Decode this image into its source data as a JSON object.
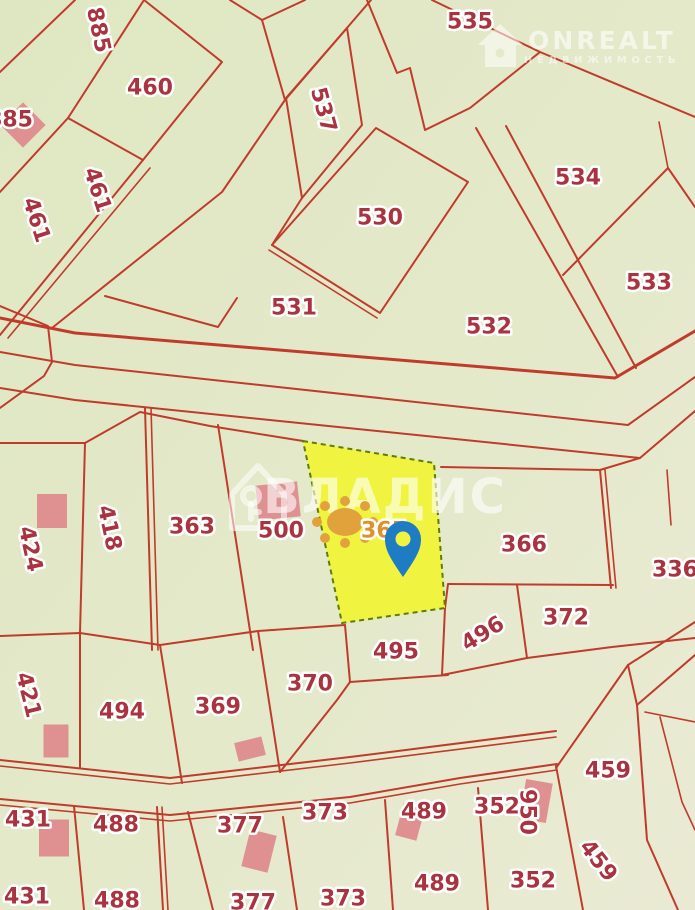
{
  "watermarks": {
    "top_right": {
      "brand": "ONREALT",
      "tagline": "НЕДВИЖИМОСТЬ"
    },
    "center": {
      "brand": "ВЛАДИС"
    }
  },
  "map": {
    "colors": {
      "background_top": "#dfe7c2",
      "background_bottom": "#eaead4",
      "boundary_line": "#c03b2c",
      "parcel_label": "#aa3340",
      "building_fill": "#df9191",
      "highlight_fill": "#f0f441",
      "highlight_border": "#5f7c05",
      "pin_color": "#1d7cc3",
      "accent_label": "#df9027"
    },
    "selected_parcel": {
      "number": "365",
      "label_x": 384,
      "label_y": 531,
      "pin": {
        "x": 403,
        "y": 577
      },
      "site_icon": {
        "cx": 345,
        "cy": 522,
        "color": "#e2a23b"
      }
    },
    "parcel_labels": [
      {
        "text": "885",
        "x": 98,
        "y": 30,
        "rot": 78
      },
      {
        "text": "460",
        "x": 150,
        "y": 88,
        "rot": 0
      },
      {
        "text": "885",
        "x": 10,
        "y": 120,
        "rot": 0
      },
      {
        "text": "461",
        "x": 97,
        "y": 190,
        "rot": 72
      },
      {
        "text": "461",
        "x": 36,
        "y": 220,
        "rot": 72
      },
      {
        "text": "535",
        "x": 470,
        "y": 22,
        "rot": 0
      },
      {
        "text": "537",
        "x": 323,
        "y": 110,
        "rot": 75
      },
      {
        "text": "530",
        "x": 380,
        "y": 218,
        "rot": 0
      },
      {
        "text": "534",
        "x": 578,
        "y": 178,
        "rot": 0
      },
      {
        "text": "531",
        "x": 294,
        "y": 308,
        "rot": 0
      },
      {
        "text": "532",
        "x": 489,
        "y": 327,
        "rot": 0
      },
      {
        "text": "533",
        "x": 649,
        "y": 283,
        "rot": 0
      },
      {
        "text": "424",
        "x": 30,
        "y": 549,
        "rot": 78
      },
      {
        "text": "418",
        "x": 109,
        "y": 528,
        "rot": 78
      },
      {
        "text": "363",
        "x": 192,
        "y": 527,
        "rot": 0
      },
      {
        "text": "500",
        "x": 281,
        "y": 531,
        "rot": 0
      },
      {
        "text": "366",
        "x": 524,
        "y": 545,
        "rot": 0
      },
      {
        "text": "336",
        "x": 675,
        "y": 570,
        "rot": 0
      },
      {
        "text": "372",
        "x": 566,
        "y": 618,
        "rot": 0
      },
      {
        "text": "496",
        "x": 483,
        "y": 634,
        "rot": -32
      },
      {
        "text": "495",
        "x": 396,
        "y": 652,
        "rot": 0
      },
      {
        "text": "370",
        "x": 310,
        "y": 684,
        "rot": 0
      },
      {
        "text": "421",
        "x": 28,
        "y": 695,
        "rot": 76
      },
      {
        "text": "494",
        "x": 122,
        "y": 712,
        "rot": 0
      },
      {
        "text": "369",
        "x": 218,
        "y": 707,
        "rot": 0
      },
      {
        "text": "431",
        "x": 28,
        "y": 820,
        "rot": 0
      },
      {
        "text": "488",
        "x": 116,
        "y": 825,
        "rot": 0
      },
      {
        "text": "377",
        "x": 240,
        "y": 826,
        "rot": 0
      },
      {
        "text": "373",
        "x": 325,
        "y": 813,
        "rot": 0
      },
      {
        "text": "489",
        "x": 424,
        "y": 812,
        "rot": 0
      },
      {
        "text": "352",
        "x": 497,
        "y": 807,
        "rot": 0
      },
      {
        "text": "950",
        "x": 527,
        "y": 812,
        "rot": 90
      },
      {
        "text": "459",
        "x": 608,
        "y": 771,
        "rot": 0
      },
      {
        "text": "459",
        "x": 598,
        "y": 861,
        "rot": 52
      },
      {
        "text": "431",
        "x": 27,
        "y": 897,
        "rot": 0
      },
      {
        "text": "488",
        "x": 117,
        "y": 901,
        "rot": 0
      },
      {
        "text": "377",
        "x": 253,
        "y": 903,
        "rot": 0
      },
      {
        "text": "373",
        "x": 343,
        "y": 899,
        "rot": 0
      },
      {
        "text": "489",
        "x": 437,
        "y": 884,
        "rot": 0
      },
      {
        "text": "352",
        "x": 533,
        "y": 881,
        "rot": 0
      }
    ],
    "buildings": [
      {
        "cx": 23,
        "cy": 125,
        "w": 32,
        "h": 32,
        "rot": 45
      },
      {
        "cx": 52,
        "cy": 511,
        "w": 30,
        "h": 34,
        "rot": 0
      },
      {
        "cx": 278,
        "cy": 501,
        "w": 42,
        "h": 35,
        "rot": -6
      },
      {
        "cx": 56,
        "cy": 741,
        "w": 25,
        "h": 33,
        "rot": 0
      },
      {
        "cx": 250,
        "cy": 749,
        "w": 28,
        "h": 19,
        "rot": -14
      },
      {
        "cx": 54,
        "cy": 838,
        "w": 30,
        "h": 37,
        "rot": 0
      },
      {
        "cx": 259,
        "cy": 851,
        "w": 27,
        "h": 38,
        "rot": 14
      },
      {
        "cx": 536,
        "cy": 801,
        "w": 27,
        "h": 40,
        "rot": 10
      },
      {
        "cx": 410,
        "cy": 822,
        "w": 22,
        "h": 33,
        "rot": 15
      }
    ]
  }
}
